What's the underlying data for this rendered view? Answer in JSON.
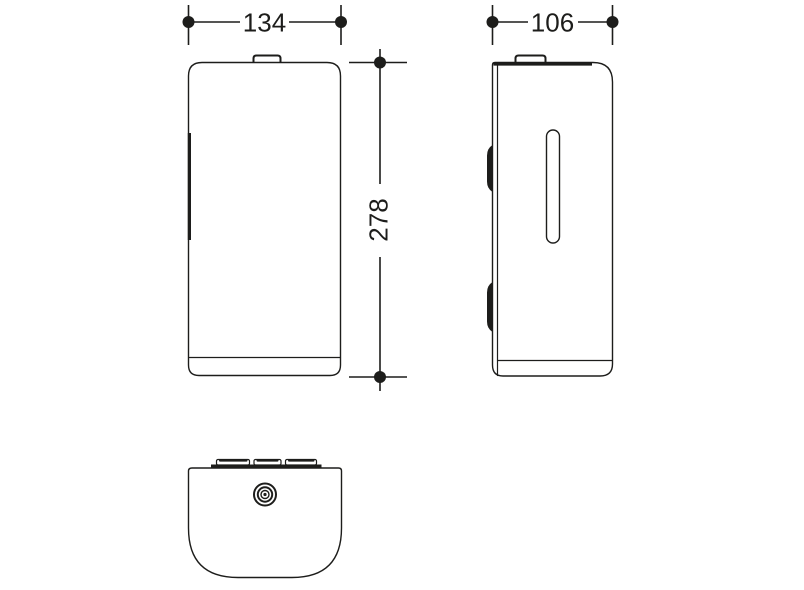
{
  "drawing": {
    "background_color": "#ffffff",
    "line_color": "#1d1d1b",
    "dimensions": {
      "width": {
        "value": "134"
      },
      "height": {
        "value": "278"
      },
      "depth": {
        "value": "106"
      }
    }
  }
}
